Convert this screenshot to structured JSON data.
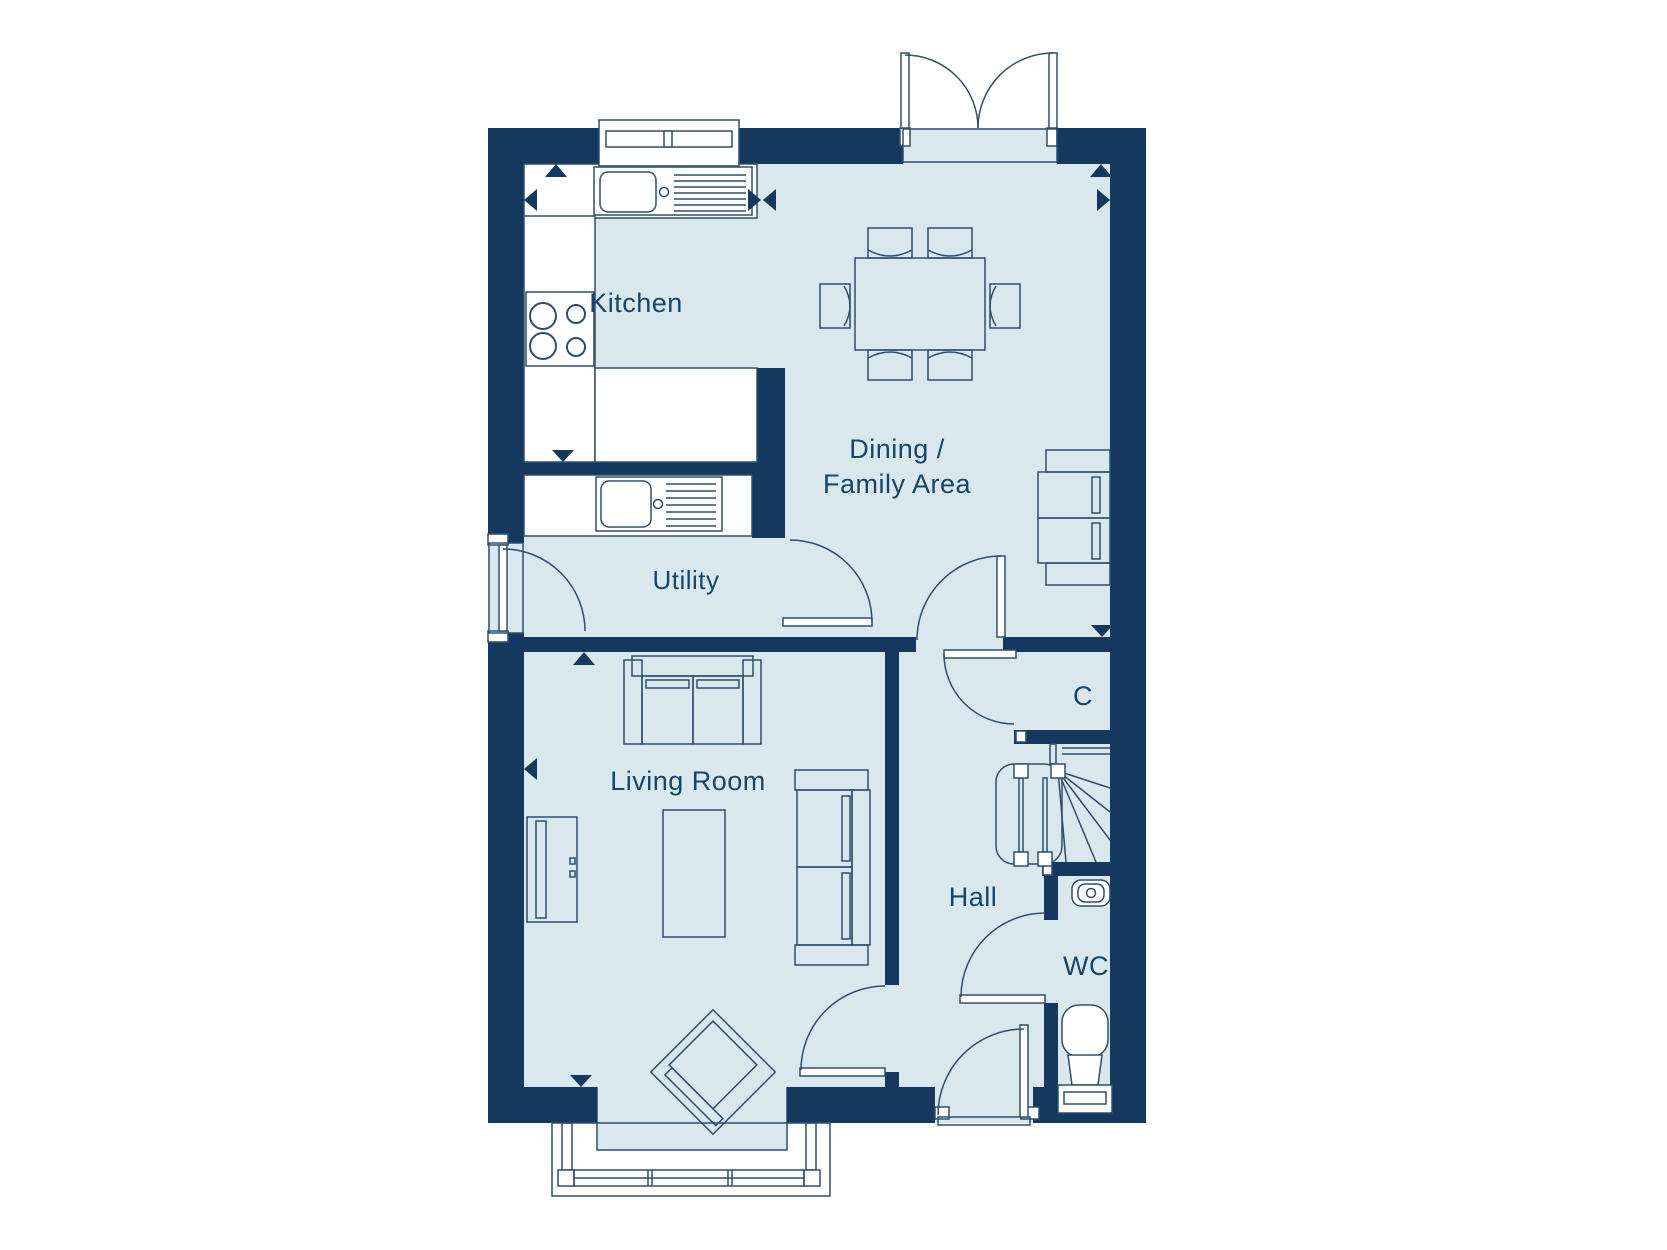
{
  "floorplan": {
    "labels": {
      "kitchen": "Kitchen",
      "dining_line1": "Dining /",
      "dining_line2": "Family Area",
      "utility": "Utility",
      "living_room": "Living Room",
      "hall": "Hall",
      "cupboard": "C",
      "wc": "WC"
    },
    "colors": {
      "wall": "#15395E",
      "floor": "#D9E8EC",
      "line": "#2F4E6E",
      "label_text": "#17446B",
      "background": "#FFFFFF"
    }
  }
}
